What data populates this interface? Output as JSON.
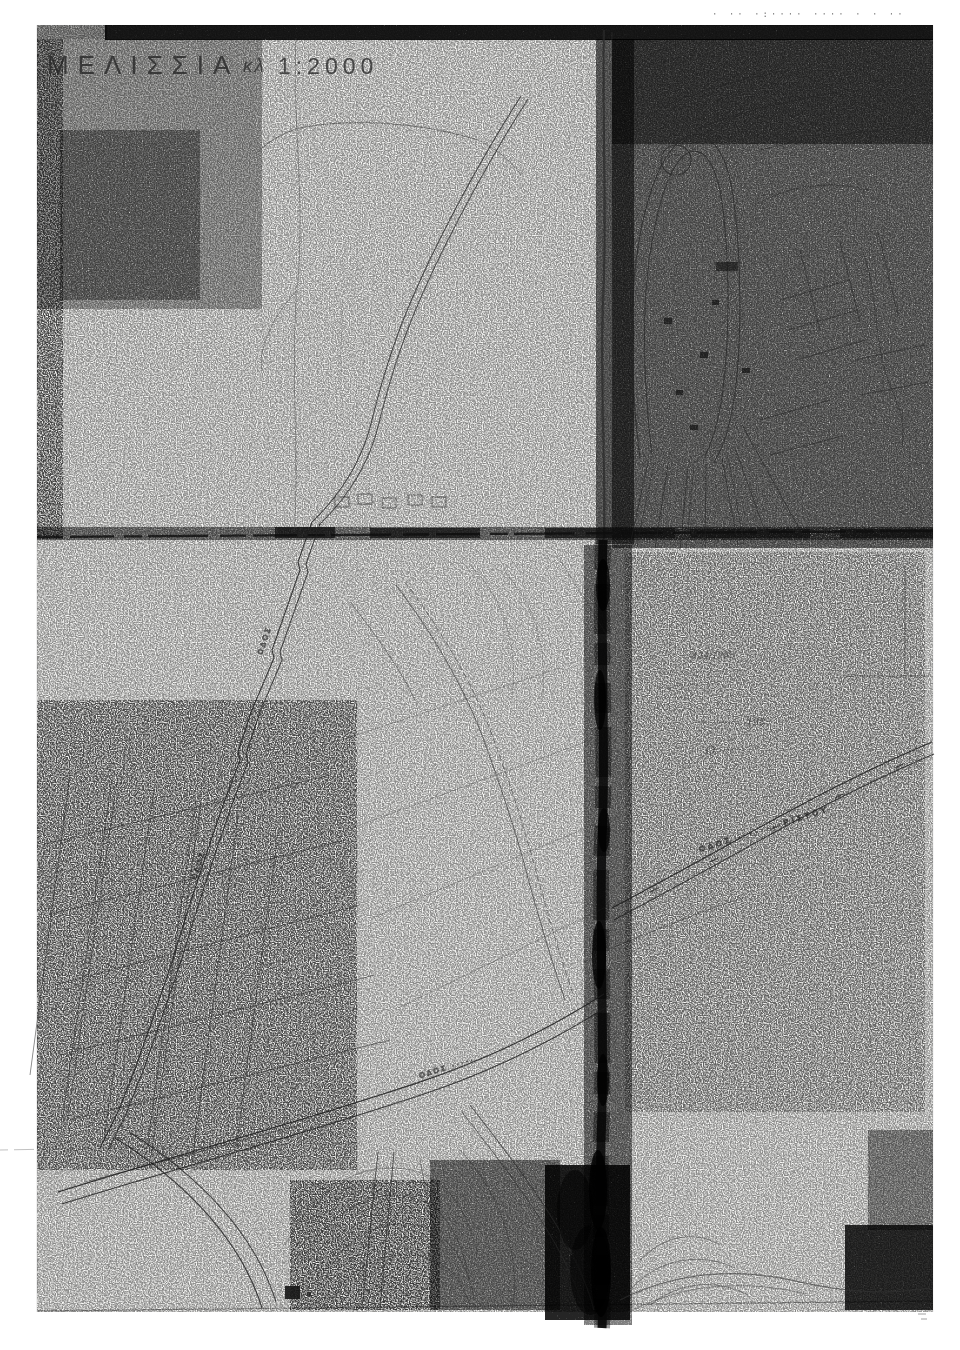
{
  "sheet": {
    "title": "ΜΕΛΙΣΣΙΑ",
    "scale_label": "κλ",
    "scale_value": "1:2000",
    "top_edge_marks": "· ·· ·:···· ···· · · ··",
    "road_labels": {
      "left_road_upper": "ΟΔΟΣ",
      "left_road_lower": "ΟΔΟΣ",
      "right_curved_road": "ΟΔΟΣ ········ΡΙΣΤΟΥ",
      "bottom_avenue": "ΟΔΟΣ ·····"
    },
    "handwritten_note": {
      "lines": [
        "· 434/1983",
        "··· ········ ··· ·········· ·········· ·",
        "··· ··· ··········· ······",
        "······ ········/",
        "·· ·········· 198·",
        "Ο ·······"
      ]
    },
    "colors": {
      "paper": "#fbfbf9",
      "ink": "#1c1c1c",
      "grey_wash": "#808080"
    }
  }
}
